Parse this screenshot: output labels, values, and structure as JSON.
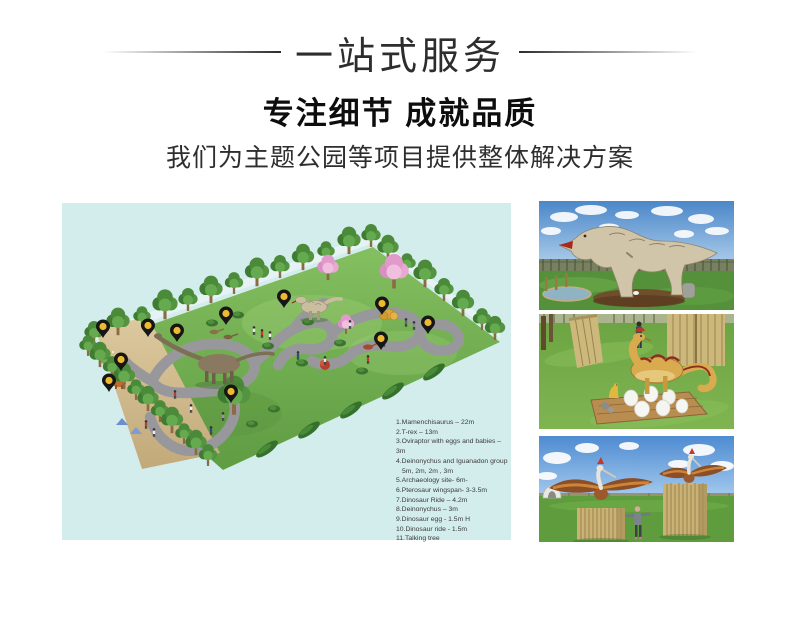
{
  "header": {
    "banner_title": "一站式服务",
    "heading": "专注细节 成就品质",
    "subheading": "我们为主题公园等项目提供整体解决方案"
  },
  "park_plan": {
    "legend_items": [
      "1.Mamenchisaurus – 22m",
      "2.T-rex – 13m",
      "3.Oviraptor with eggs and babies – 3m",
      "4.Deinonychus and Iguanadon group",
      "5m, 2m, 2m , 3m",
      "5.Archaeology site- 6m-",
      "6.Pterosaur  wingspan- 3-3.5m",
      "7.Dinosaur Ride – 4.2m",
      "8.Deinonychus – 3m",
      "9.Dinosaur egg - 1.5m H",
      "10.Dinosaur ride -  1.5m",
      "11.Talking tree"
    ],
    "pin_count": 11
  },
  "colors": {
    "plan_background": "#d3eded",
    "field_green": "#6fae4e",
    "path_gray": "#98989c",
    "sand": "#d2bd90",
    "pin_black": "#161616",
    "pin_yellow": "#ecba2e",
    "blossom_pink": "#e8a8d2",
    "heading_black": "#0d0d0d"
  }
}
